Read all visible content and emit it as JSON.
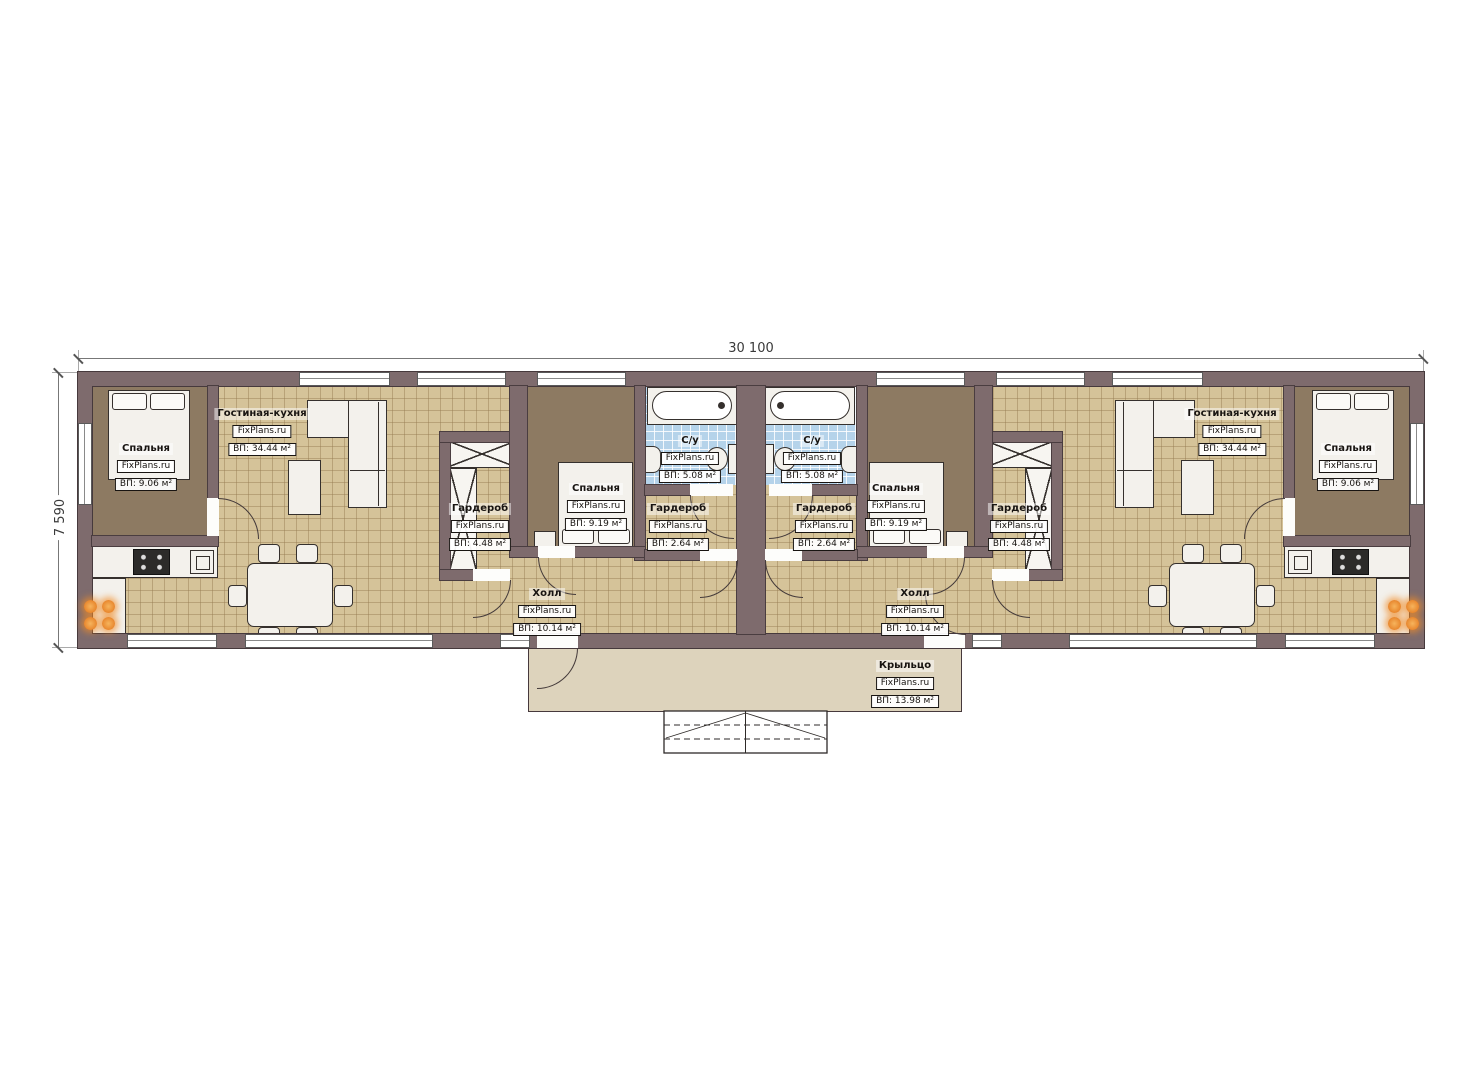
{
  "brand": "FixPlans.ru",
  "dimensions": {
    "top": "30 100",
    "left": "7 590"
  },
  "rooms": {
    "l_bedroom1": {
      "name": "Спальня",
      "area": "ВП: 9.06 м²"
    },
    "l_living": {
      "name": "Гостиная-кухня",
      "area": "ВП: 34.44 м²"
    },
    "l_wardrobe1": {
      "name": "Гардероб",
      "area": "ВП: 4.48 м²"
    },
    "l_bedroom2": {
      "name": "Спальня",
      "area": "ВП: 9.19 м²"
    },
    "l_bath": {
      "name": "С/у",
      "area": "ВП: 5.08 м²"
    },
    "l_wardrobe2": {
      "name": "Гардероб",
      "area": "ВП: 2.64 м²"
    },
    "l_hall": {
      "name": "Холл",
      "area": "ВП: 10.14 м²"
    },
    "r_bedroom1": {
      "name": "Спальня",
      "area": "ВП: 9.06 м²"
    },
    "r_living": {
      "name": "Гостиная-кухня",
      "area": "ВП: 34.44 м²"
    },
    "r_wardrobe1": {
      "name": "Гардероб",
      "area": "ВП: 4.48 м²"
    },
    "r_bedroom2": {
      "name": "Спальня",
      "area": "ВП: 9.19 м²"
    },
    "r_bath": {
      "name": "С/у",
      "area": "ВП: 5.08 м²"
    },
    "r_wardrobe2": {
      "name": "Гардероб",
      "area": "ВП: 2.64 м²"
    },
    "r_hall": {
      "name": "Холл",
      "area": "ВП: 10.14 м²"
    },
    "porch": {
      "name": "Крыльцо",
      "area": "ВП: 13.98 м²"
    }
  },
  "colors": {
    "wall": "#7e6b6d",
    "floor_tile": "#d5c399",
    "bedroom_floor": "#8d7a62",
    "bath_tile": "#b5d3ea",
    "porch": "#ddd3bc",
    "burner_orange": "#e8872e"
  }
}
